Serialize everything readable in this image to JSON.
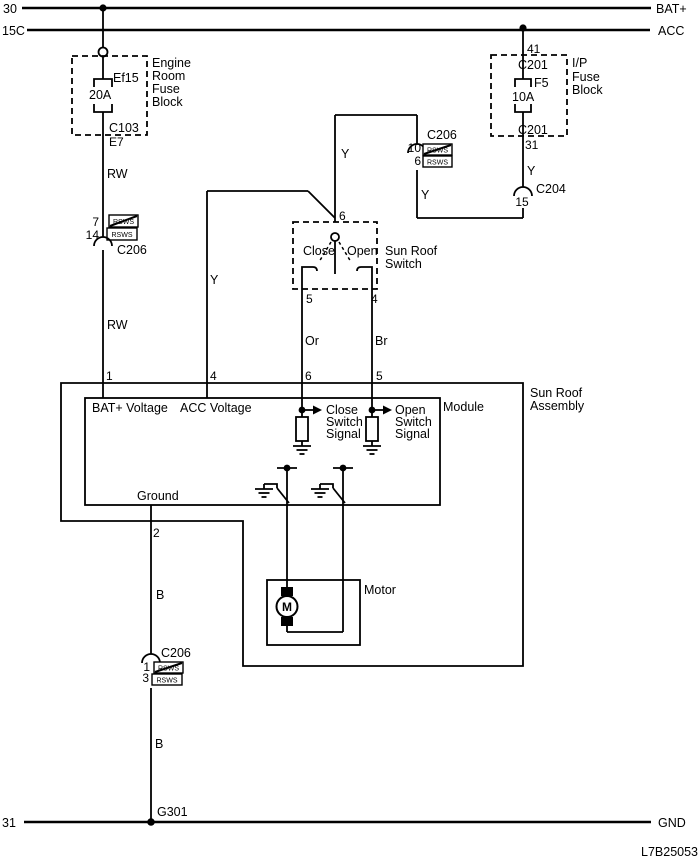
{
  "diagram_code": "L7B25053",
  "buses": {
    "bat": {
      "left": "30",
      "right": "BAT+"
    },
    "acc": {
      "left": "15C",
      "right": "ACC"
    },
    "gnd": {
      "left": "31",
      "right": "GND"
    }
  },
  "ground_point": "G301",
  "engine_fuse_block": {
    "name": [
      "Engine",
      "Room",
      "Fuse",
      "Block"
    ],
    "fuse": "Ef15",
    "rating": "20A",
    "connector": "C103",
    "pin": "E7"
  },
  "ip_fuse_block": {
    "name": [
      "I/P",
      "Fuse",
      "Block"
    ],
    "pin_in": "41",
    "connector_in": "C201",
    "fuse": "F5",
    "rating": "10A",
    "connector_out": "C201",
    "pin_out": "31"
  },
  "wires": {
    "rw1": "RW",
    "rw2": "RW",
    "y_switch": "Y",
    "y_module": "Y",
    "y_link": "Y",
    "y_ip": "Y",
    "or_wire": "Or",
    "br_wire": "Br",
    "b1": "B",
    "b2": "B"
  },
  "connectors": {
    "c206_left": {
      "name": "C206",
      "pin_a": "7",
      "pin_b": "14",
      "code_a": "RSWS",
      "code_b": "RSWS"
    },
    "c206_right": {
      "name": "C206",
      "pin_a": "10",
      "pin_b": "6",
      "code_a": "RSWS",
      "code_b": "RSWS"
    },
    "c206_bottom": {
      "name": "C206",
      "pin_a": "1",
      "pin_b": "3",
      "code_a": "RSWS",
      "code_b": "RSWS"
    },
    "c204": {
      "name": "C204",
      "pin": "15"
    }
  },
  "switch": {
    "name": [
      "Sun Roof",
      "Switch"
    ],
    "close": "Close",
    "open": "Open",
    "pin_common": "6",
    "pin_close": "5",
    "pin_open": "4"
  },
  "assembly": {
    "name": [
      "Sun Roof",
      "Assembly"
    ],
    "module": "Module",
    "motor": "Motor",
    "motor_letter": "M",
    "pin_bat": "1",
    "pin_acc": "4",
    "pin_close": "6",
    "pin_open": "5",
    "pin_gnd": "2",
    "bat_label": "BAT+ Voltage",
    "acc_label": "ACC Voltage",
    "close_label": [
      "Close",
      "Switch",
      "Signal"
    ],
    "open_label": [
      "Open",
      "Switch",
      "Signal"
    ],
    "ground_label": "Ground"
  }
}
